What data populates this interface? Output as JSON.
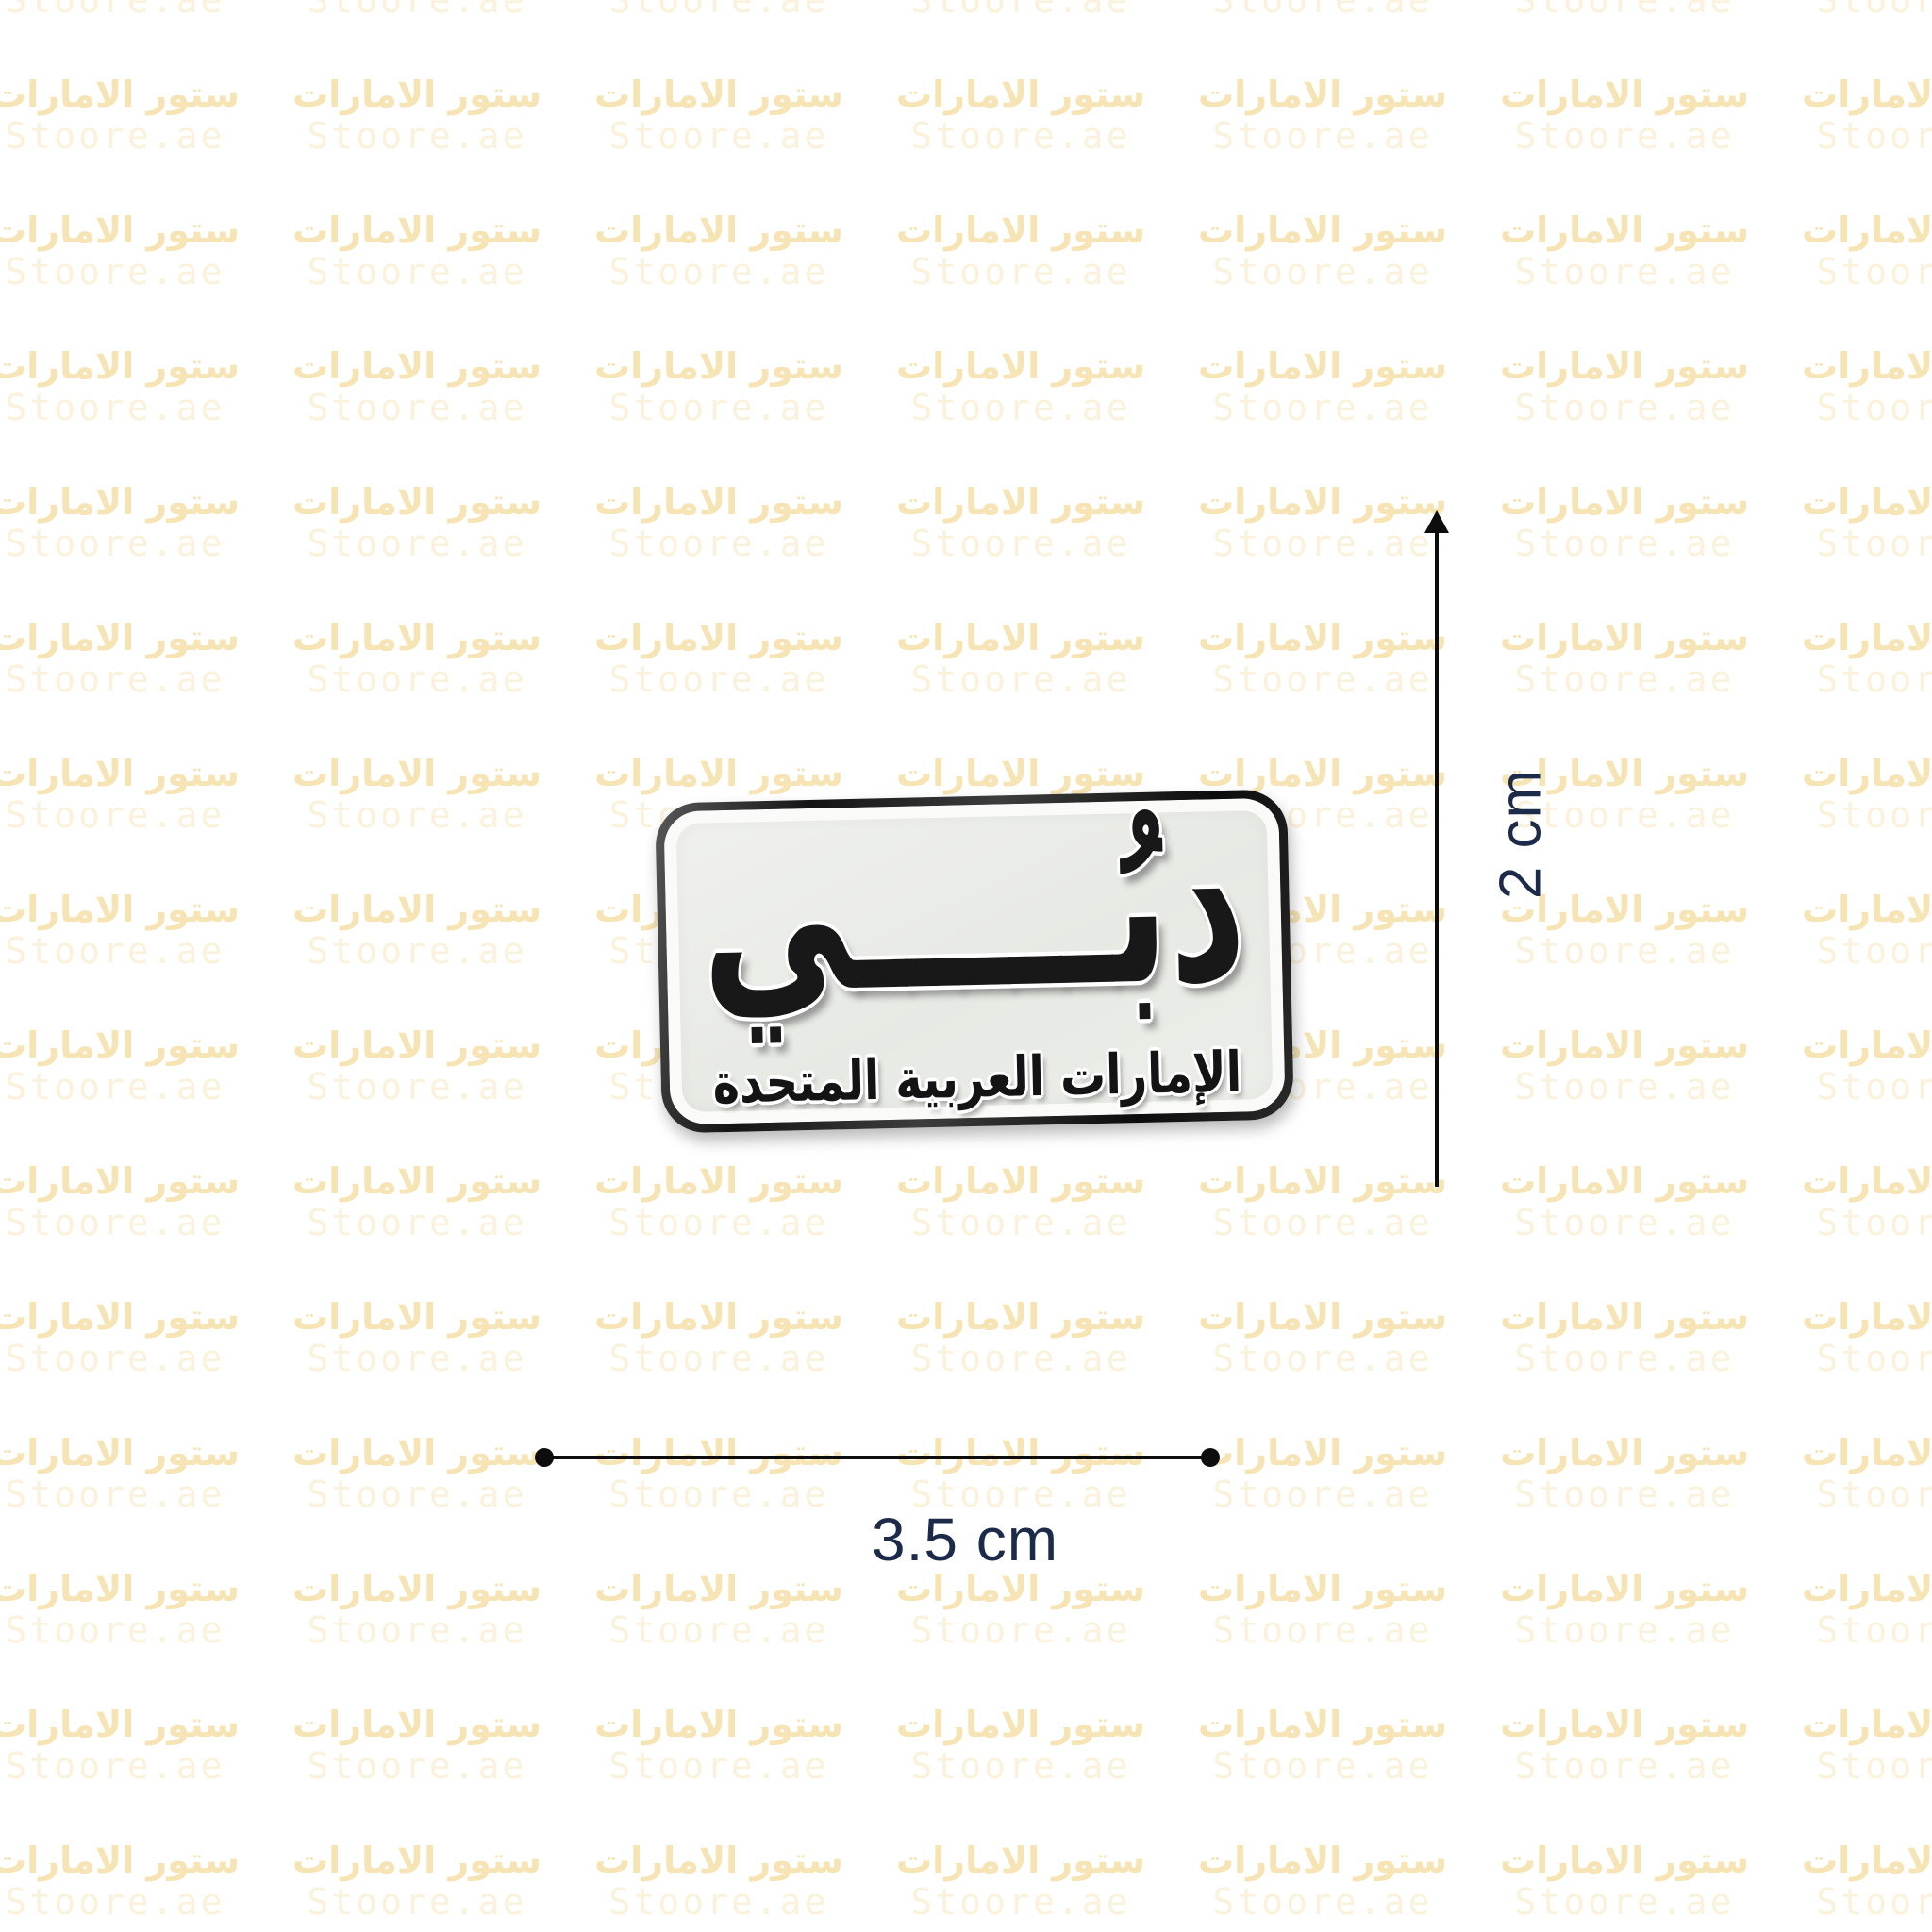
{
  "page": {
    "background": "#ffffff",
    "description_text_color": "#1d2b4a"
  },
  "watermark": {
    "arabic": "ستور الامارات",
    "latin": "Stoore.ae",
    "arabic_color": "#f6e4b4",
    "latin_color": "#fbf2dc",
    "grid": {
      "col_start": 122,
      "col_step": 320,
      "cols": 7,
      "row_start": 101,
      "row_step": 144,
      "row_from": -1,
      "row_to": 13
    }
  },
  "pin": {
    "city_text": "دبي",
    "city_text_display": "دبُـــــي",
    "country_text": "الإمارات العربية المتحدة",
    "face_color": "#e8eae5",
    "rim_color": "#fafbf8",
    "border_color": "#1a1a1a",
    "text_color": "#181818"
  },
  "dimensions": {
    "height": {
      "label": "2 cm"
    },
    "width": {
      "label": "3.5 cm"
    },
    "text_color": "#1d2b4a",
    "line_color": "#0d0d0d"
  }
}
